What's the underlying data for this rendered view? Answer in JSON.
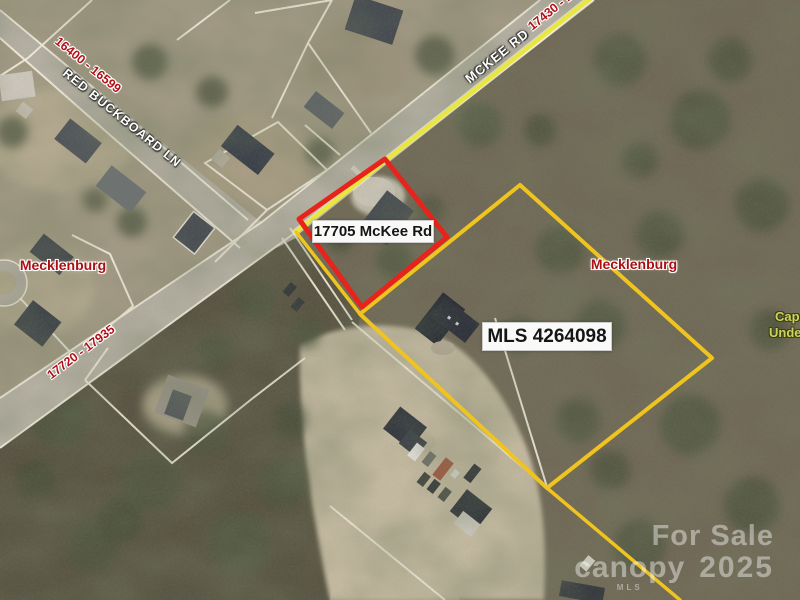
{
  "map": {
    "labels": {
      "property_address": "17705 McKee Rd",
      "mls_number": "MLS 4264098",
      "county_left": "Mecklenburg",
      "county_right": "Mecklenburg",
      "road_mckee": "MCKEE RD",
      "road_red_buckboard": "RED BUCKBOARD LN",
      "range_red_buckboard": "16400 - 16599",
      "range_mckee_upper": "17430 - 17",
      "range_mckee_lower": "17720 - 17935",
      "edge_label_line1": "Cap",
      "edge_label_line2": "Unde"
    },
    "watermark": {
      "line1": "For Sale",
      "brand": "canopy",
      "brand_sub": "MLS",
      "year": "2025"
    },
    "colors": {
      "subject_boundary": "#e8231b",
      "adjacent_boundary": "#f0c41f",
      "road_highlight": "#e9e73f",
      "county_label": "#a81014",
      "range_label": "#b01116",
      "road_label": "#ffffff",
      "edge_label": "#ccd35c",
      "parcel_line": "#f7f2e2"
    }
  }
}
